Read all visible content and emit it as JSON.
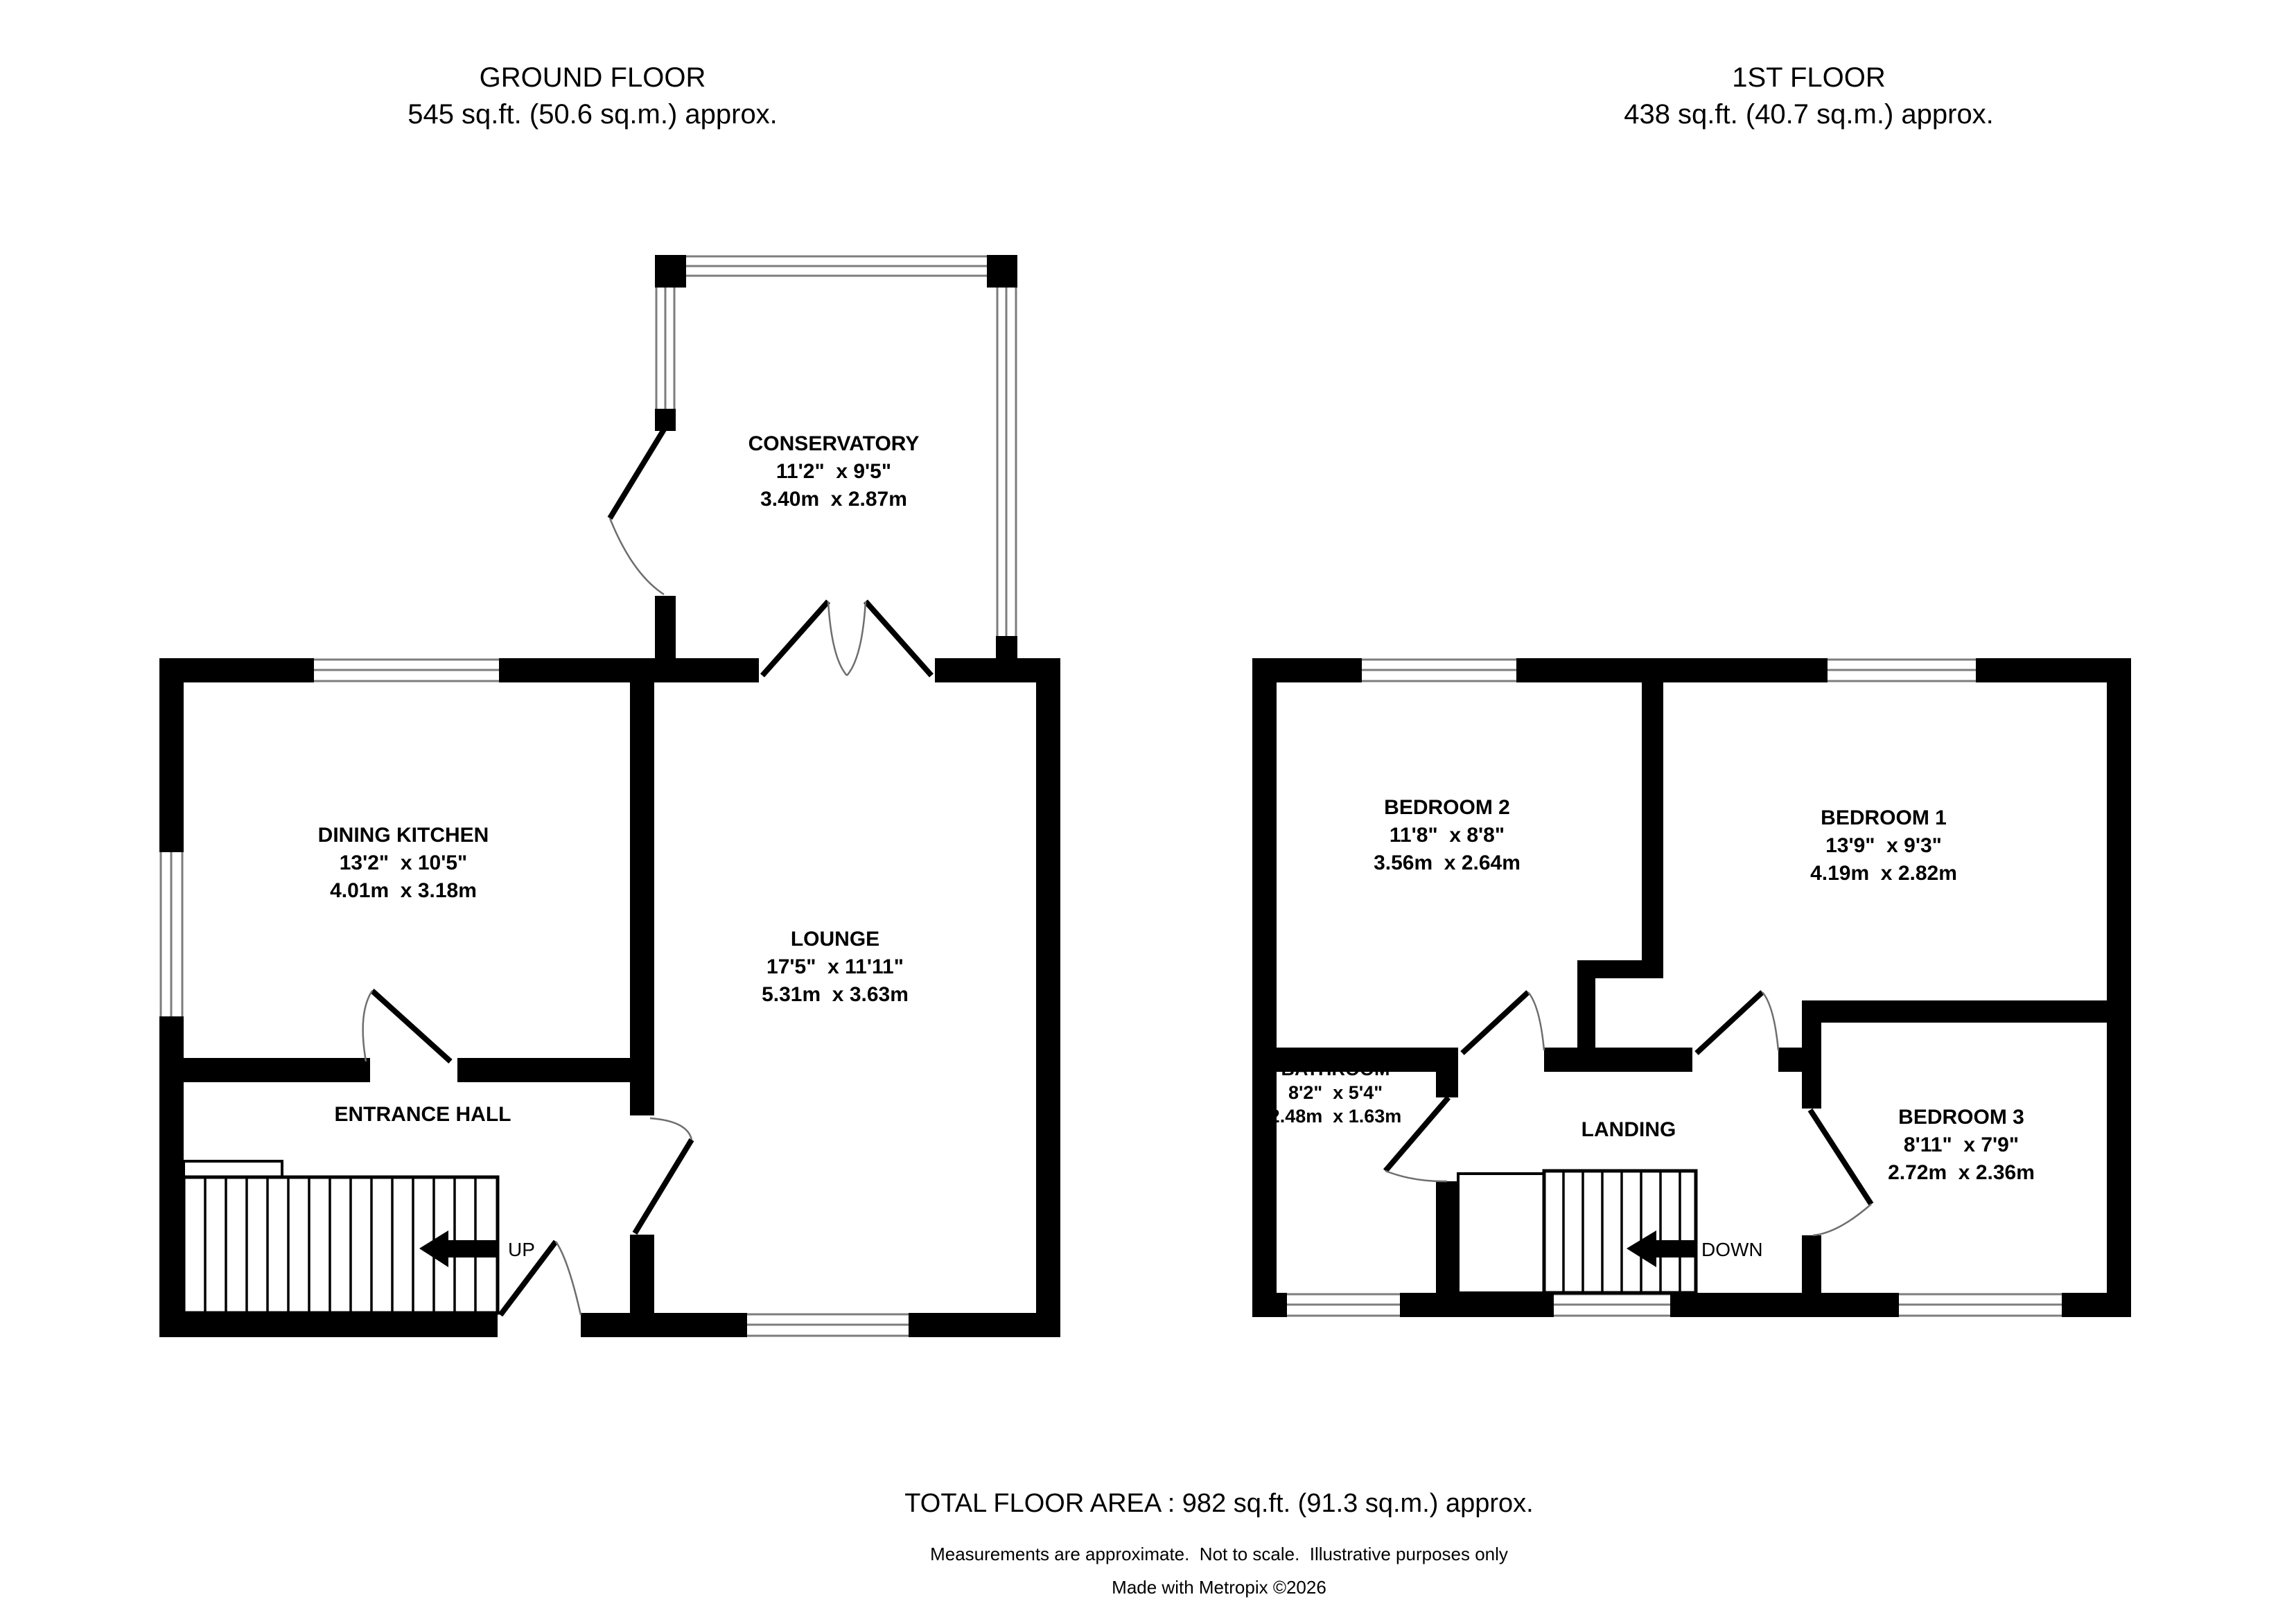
{
  "ground_floor": {
    "title": "GROUND FLOOR",
    "area": "545 sq.ft. (50.6 sq.m.) approx.",
    "stairs_label": "UP",
    "rooms": {
      "conservatory": {
        "name": "CONSERVATORY",
        "imperial": "11'2\"  x 9'5\"",
        "metric": "3.40m  x 2.87m"
      },
      "dining_kitchen": {
        "name": "DINING KITCHEN",
        "imperial": "13'2\"  x 10'5\"",
        "metric": "4.01m  x 3.18m"
      },
      "lounge": {
        "name": "LOUNGE",
        "imperial": "17'5\"  x 11'11\"",
        "metric": "5.31m  x 3.63m"
      },
      "entrance_hall": {
        "name": "ENTRANCE HALL"
      }
    }
  },
  "first_floor": {
    "title": "1ST FLOOR",
    "area": "438 sq.ft. (40.7 sq.m.) approx.",
    "stairs_label": "DOWN",
    "rooms": {
      "bedroom2": {
        "name": "BEDROOM 2",
        "imperial": "11'8\"  x 8'8\"",
        "metric": "3.56m  x 2.64m"
      },
      "bedroom1": {
        "name": "BEDROOM 1",
        "imperial": "13'9\"  x 9'3\"",
        "metric": "4.19m  x 2.82m"
      },
      "bathroom": {
        "name": "BATHROOM",
        "imperial": "8'2\"  x 5'4\"",
        "metric": "2.48m  x 1.63m"
      },
      "landing": {
        "name": "LANDING"
      },
      "bedroom3": {
        "name": "BEDROOM 3",
        "imperial": "8'11\"  x 7'9\"",
        "metric": "2.72m  x 2.36m"
      }
    }
  },
  "footer": {
    "total": "TOTAL FLOOR AREA : 982 sq.ft. (91.3 sq.m.) approx.",
    "disclaimer": "Measurements are approximate.  Not to scale.  Illustrative purposes only",
    "credit": "Made with Metropix ©2026"
  },
  "colors": {
    "wall": "#000000",
    "window_line": "#7d7d7d",
    "door_arc": "#6e6e6e",
    "background": "#ffffff"
  }
}
